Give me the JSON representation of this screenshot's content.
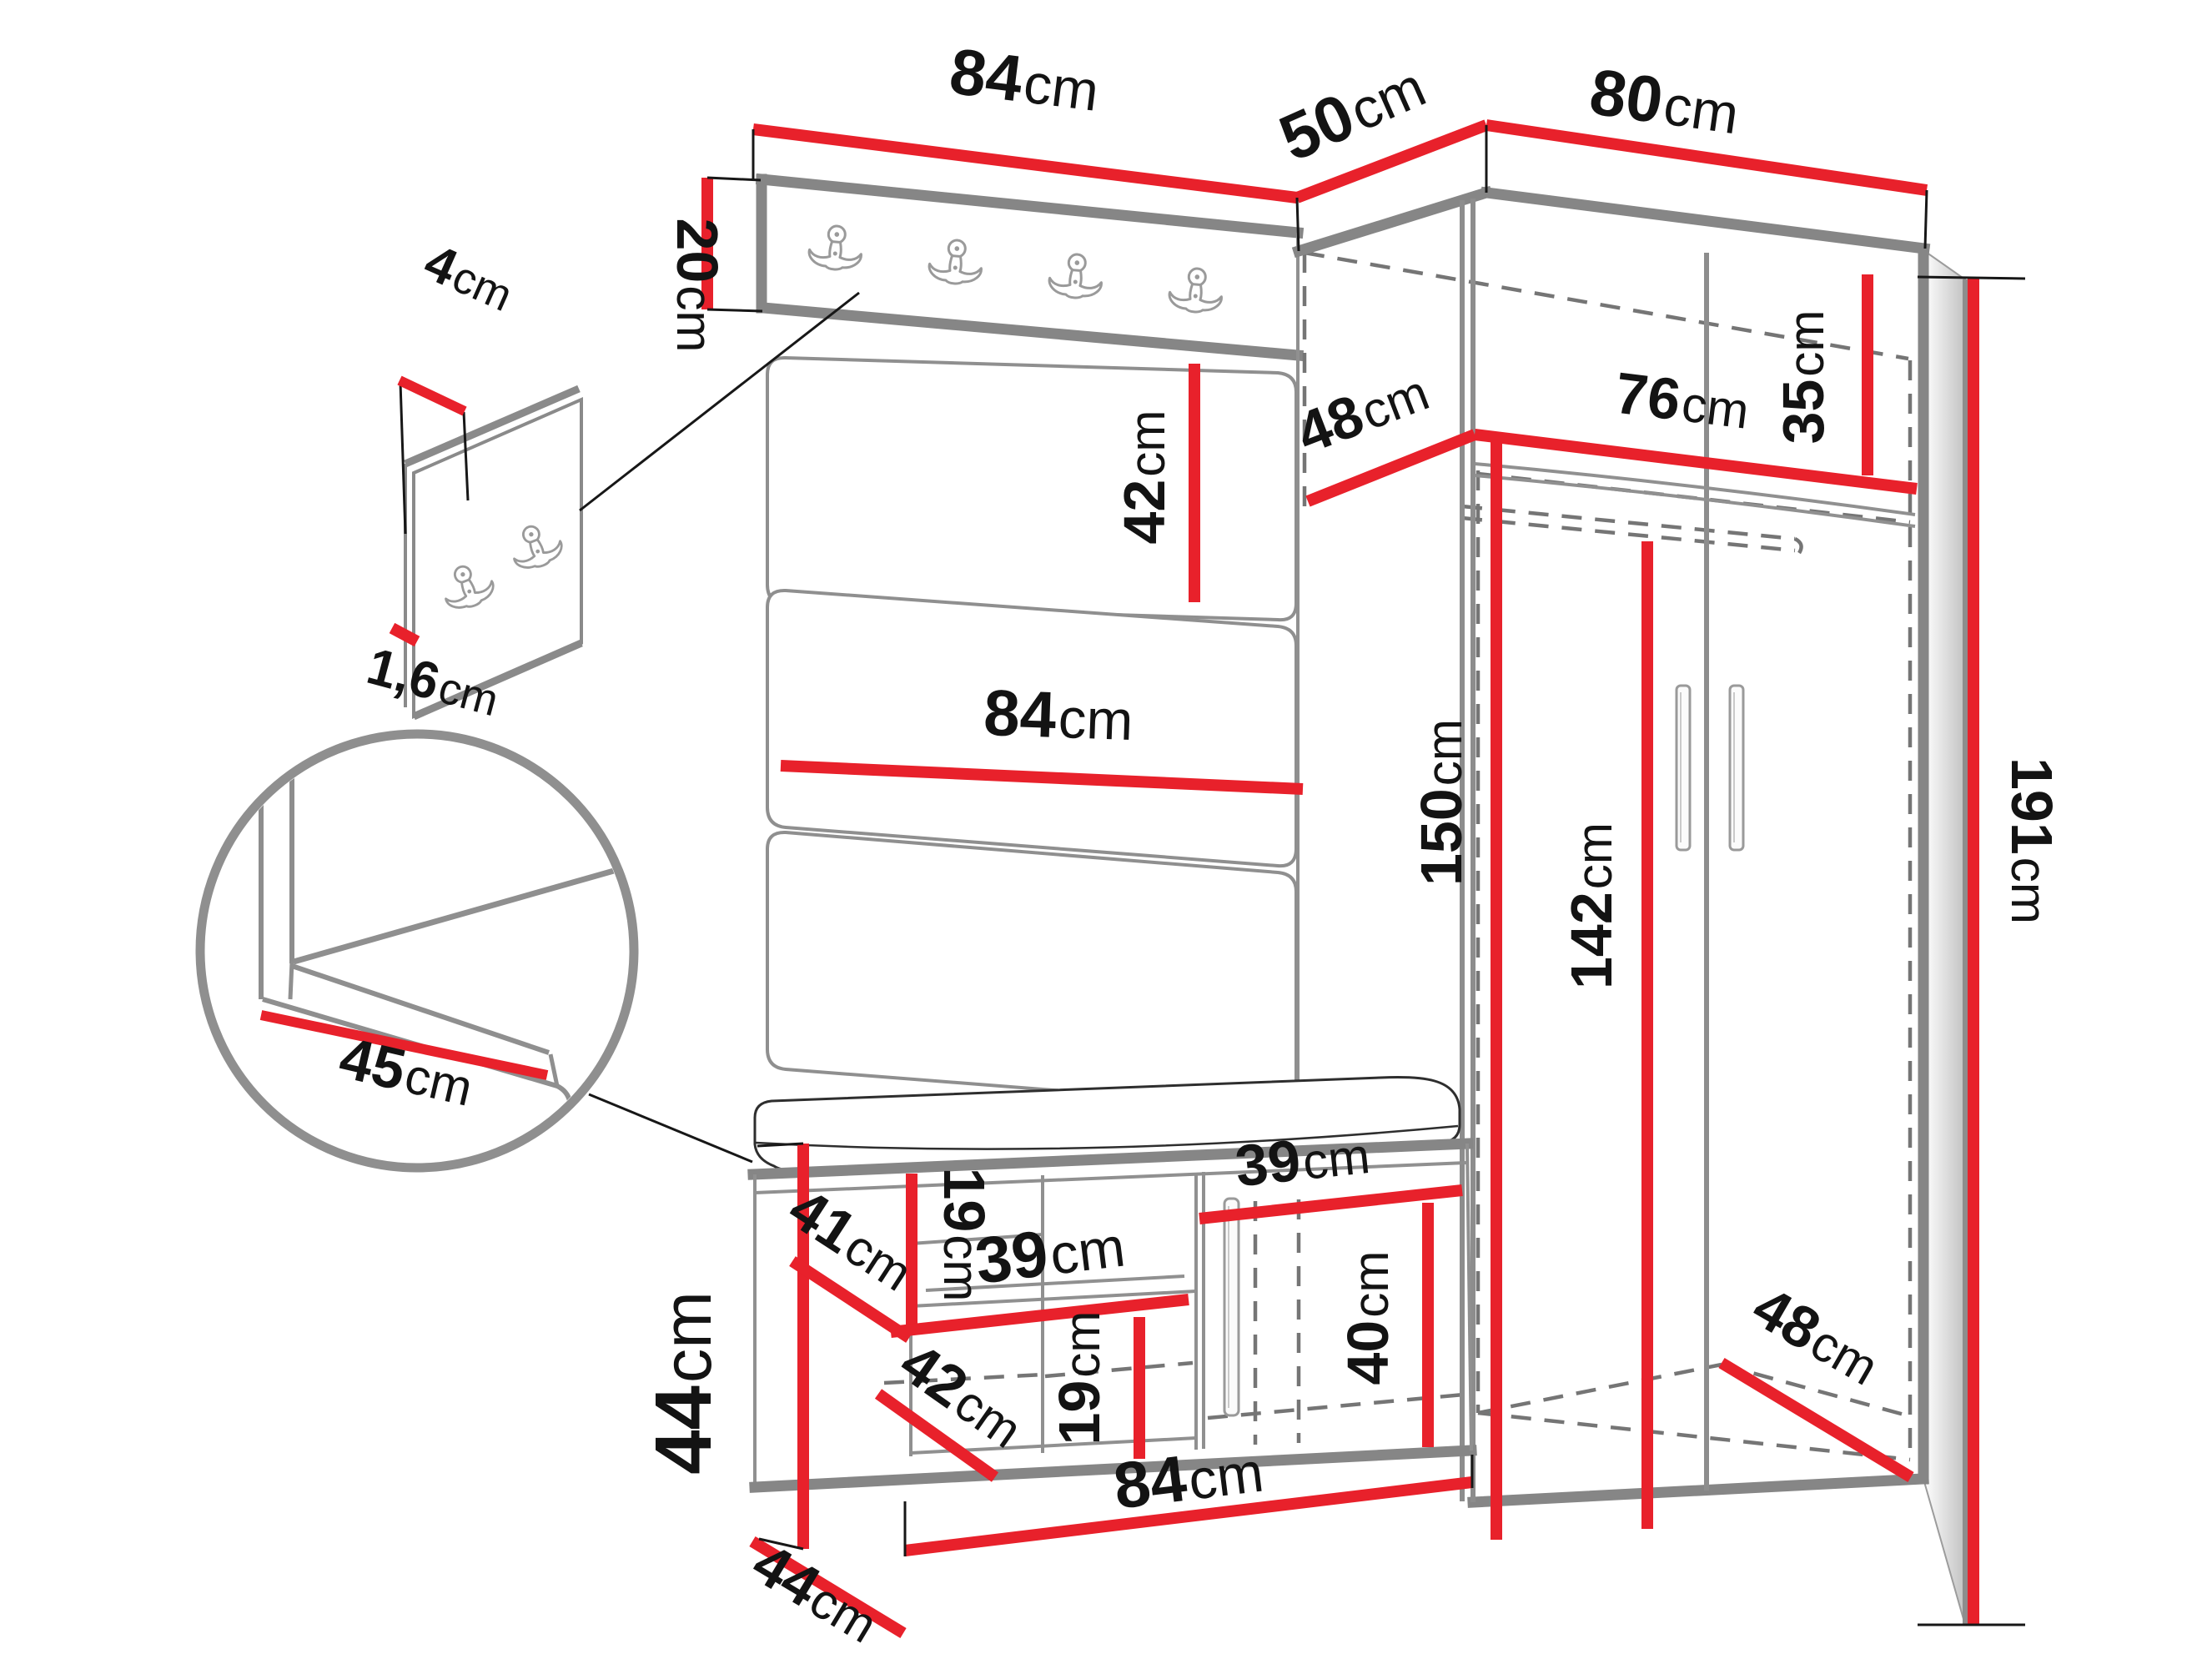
{
  "diagram": {
    "title": "hallway-furniture-dimension-drawing",
    "unit": "cm",
    "colors": {
      "dimension_line": "#e8212b",
      "structure": "#868686",
      "hidden_line": "#757575",
      "text": "#131313"
    },
    "icons": {
      "hook": "coat-hook-icon",
      "magnifier": "detail-circle"
    },
    "dims": {
      "top84": {
        "value": "84",
        "unit": "cm"
      },
      "top50": {
        "value": "50",
        "unit": "cm"
      },
      "top80": {
        "value": "80",
        "unit": "cm"
      },
      "rail20": {
        "value": "20",
        "unit": "cm"
      },
      "panel4": {
        "value": "4",
        "unit": "cm"
      },
      "panel16": {
        "value": "1,6",
        "unit": "cm"
      },
      "cushion42": {
        "value": "42",
        "unit": "cm"
      },
      "mid84": {
        "value": "84",
        "unit": "cm"
      },
      "corner48": {
        "value": "48",
        "unit": "cm"
      },
      "inner76": {
        "value": "76",
        "unit": "cm"
      },
      "shelf35": {
        "value": "35",
        "unit": "cm"
      },
      "h150": {
        "value": "150",
        "unit": "cm"
      },
      "h142": {
        "value": "142",
        "unit": "cm"
      },
      "h191": {
        "value": "191",
        "unit": "cm"
      },
      "seat45": {
        "value": "45",
        "unit": "cm"
      },
      "bench44": {
        "value": "44",
        "unit": "cm"
      },
      "bench19a": {
        "value": "19",
        "unit": "cm"
      },
      "depth41": {
        "value": "41",
        "unit": "cm"
      },
      "shelf39a": {
        "value": "39",
        "unit": "cm"
      },
      "depth42b": {
        "value": "42",
        "unit": "cm"
      },
      "bench19b": {
        "value": "19",
        "unit": "cm"
      },
      "door39": {
        "value": "39",
        "unit": "cm"
      },
      "door40": {
        "value": "40",
        "unit": "cm"
      },
      "depth48b": {
        "value": "48",
        "unit": "cm"
      },
      "bottom84": {
        "value": "84",
        "unit": "cm"
      },
      "depth44b": {
        "value": "44",
        "unit": "cm"
      }
    }
  }
}
